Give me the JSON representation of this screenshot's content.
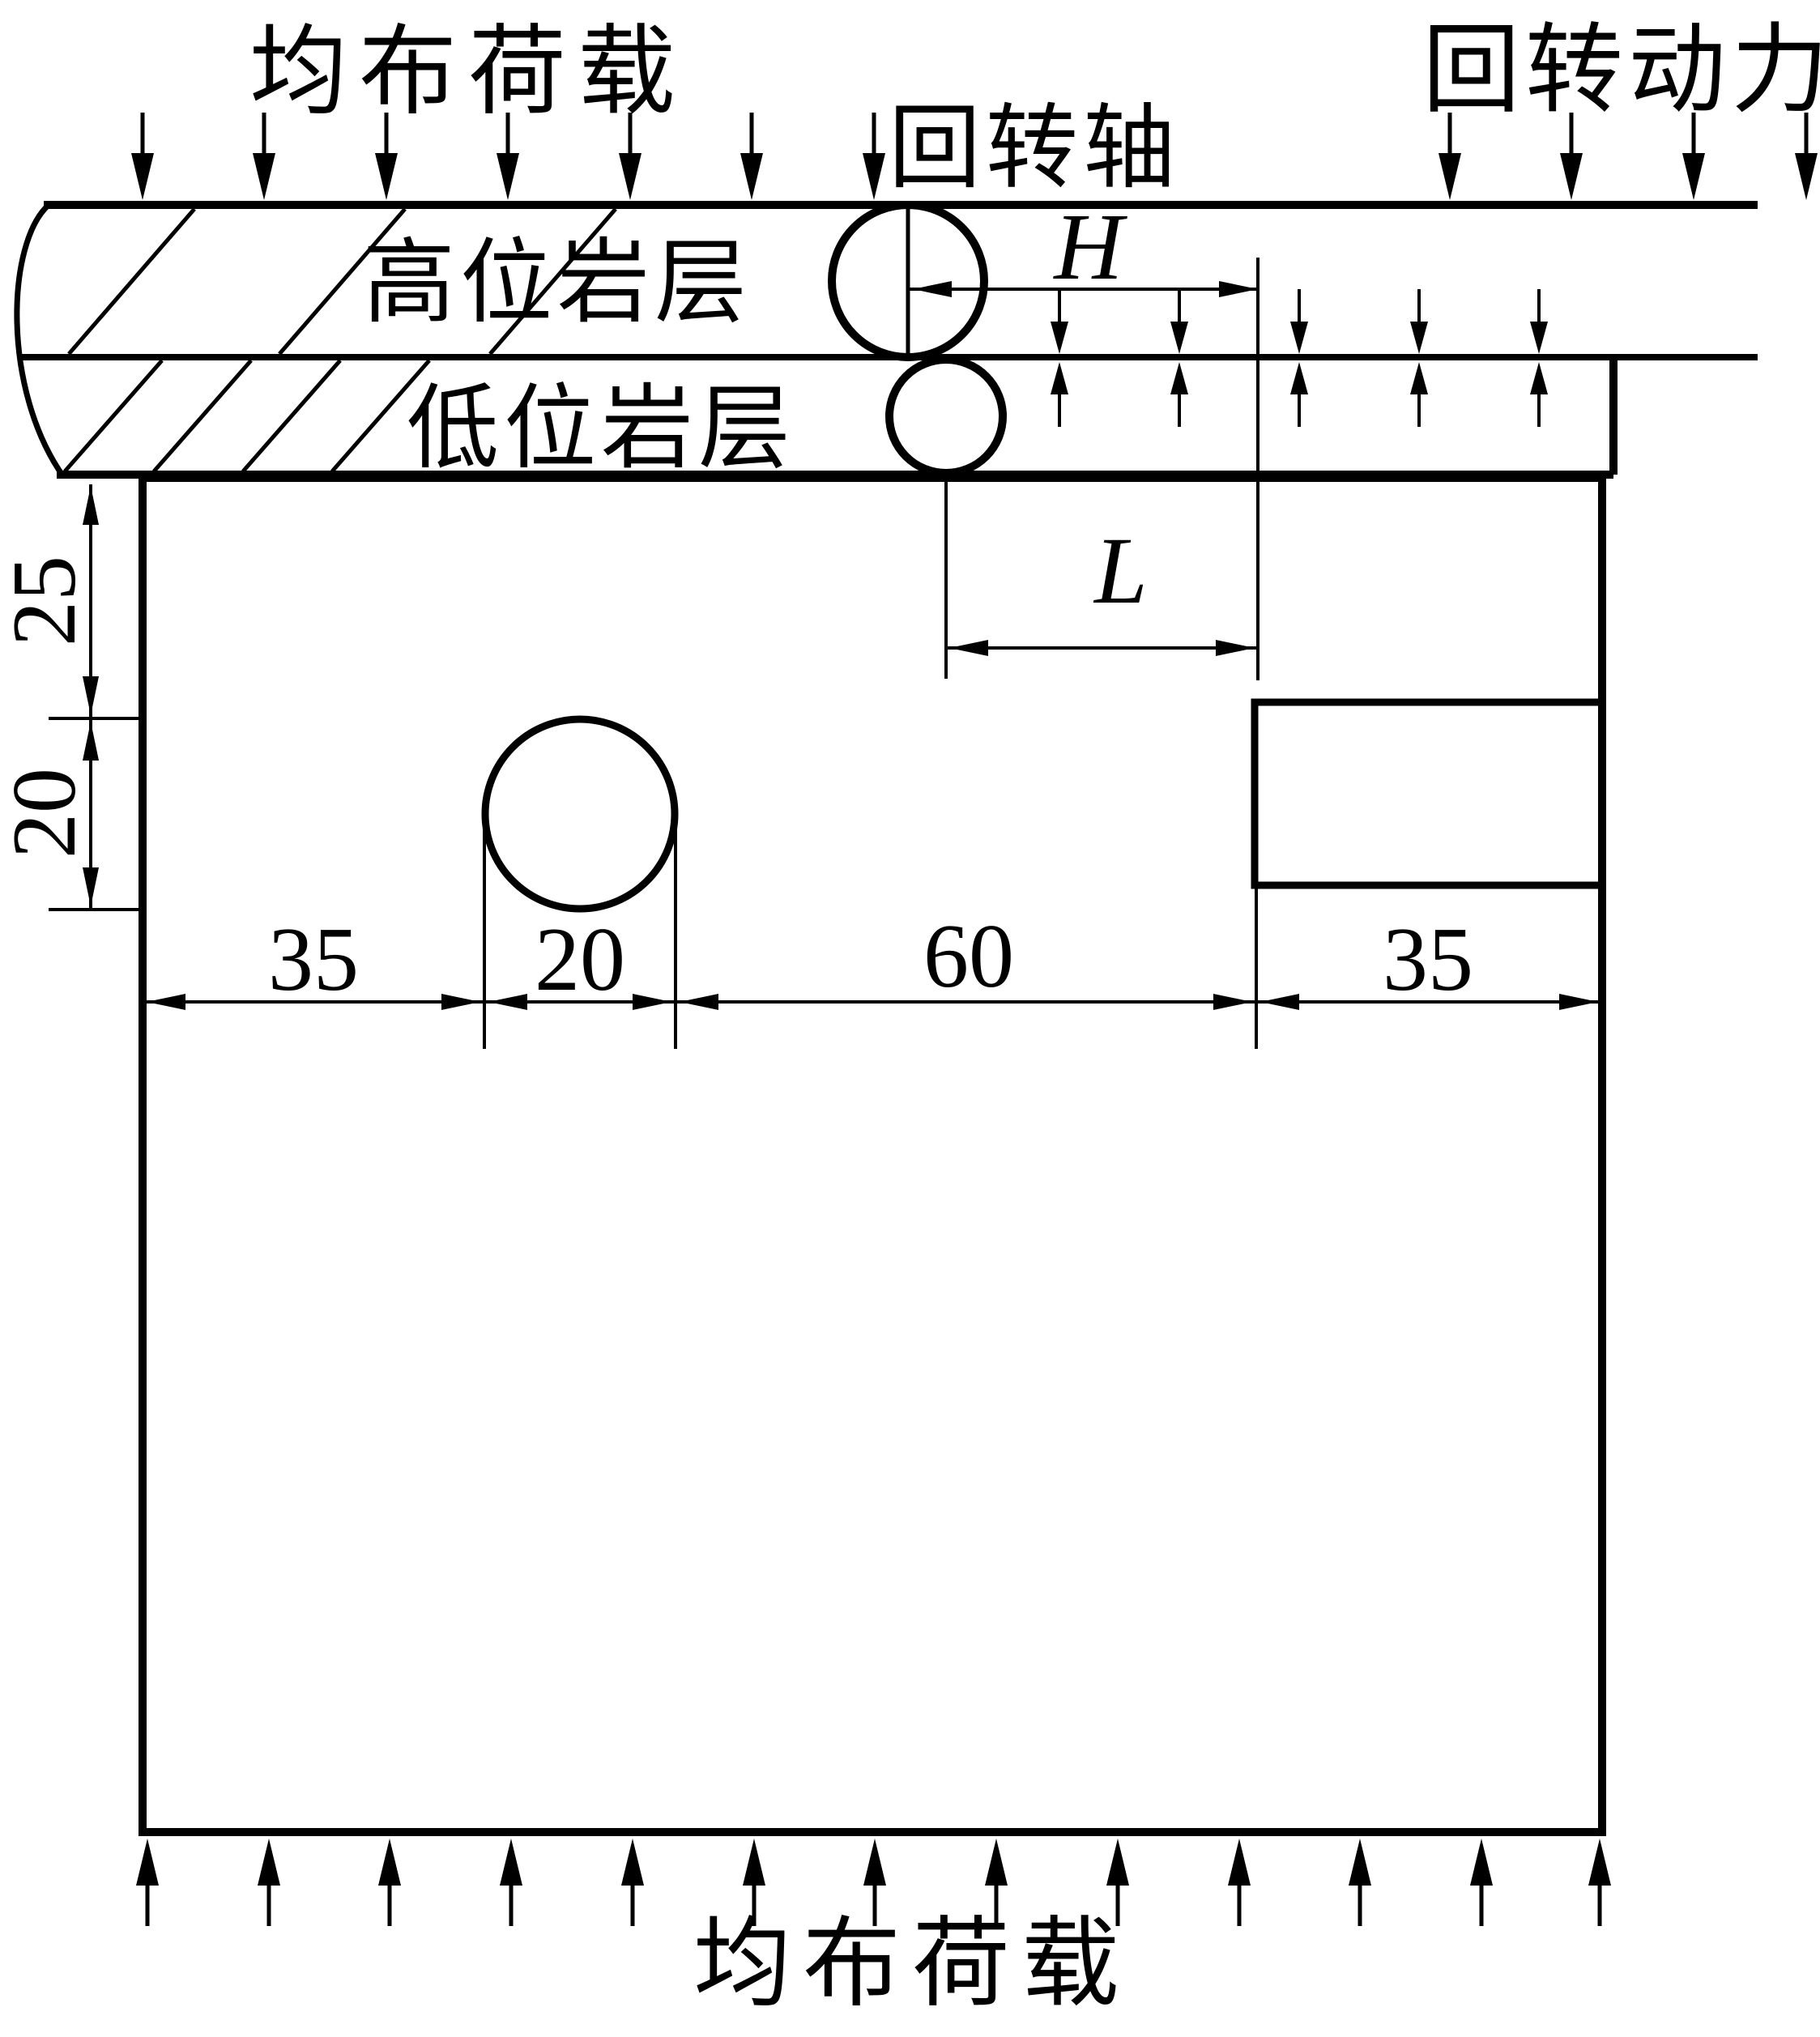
{
  "diagram": {
    "labels": {
      "load_top": "均布荷载",
      "load_bottom": "均布荷载",
      "rotary_power": "回转动力",
      "rotary_axis": "回转轴",
      "upper_stratum": "高位岩层",
      "lower_stratum": "低位岩层"
    },
    "dims": {
      "H": "H",
      "L": "L",
      "left_25": "25",
      "left_20": "20",
      "bottom_35_left": "35",
      "bottom_20": "20",
      "bottom_60": "60",
      "bottom_35_right": "35"
    },
    "colors": {
      "ink": "#000000",
      "paper": "#ffffff"
    }
  }
}
